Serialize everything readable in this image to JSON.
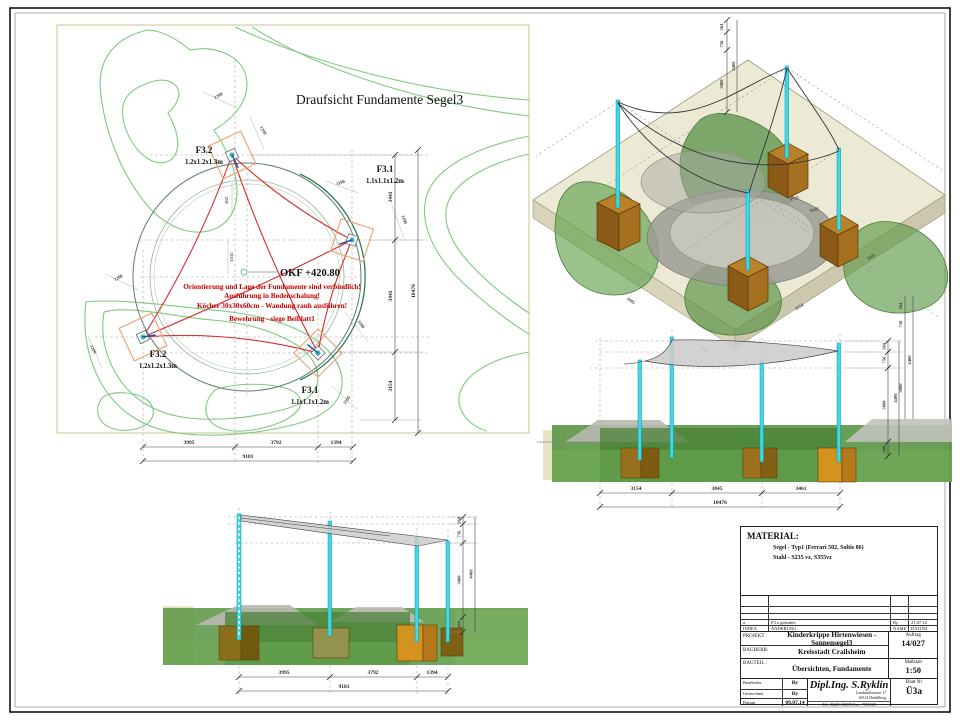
{
  "plan": {
    "title": "Draufsicht Fundamente Segel3",
    "okf": "OKF +420.80",
    "notes": [
      "Orientierung und Lage der Fundamente sind verbindlich!",
      "Ausführung in Bodenschalung!",
      "Köcher 30x30x60cm - Wandung rauh ausführen!",
      "Bewehrung - siege Beiblatt1"
    ],
    "foundations": [
      {
        "id": "F3.2",
        "size": "1.2x1.2x1.3m"
      },
      {
        "id": "F3.1",
        "size": "1.1x1.1x1.2m"
      },
      {
        "id": "F3.2",
        "size": "1.2x1.2x1.3m"
      },
      {
        "id": "F3.1",
        "size": "1.1x1.1x1.2m"
      }
    ],
    "dims": {
      "pocket_1200": "1200",
      "pocket_1100": "1100",
      "center_v": "1515",
      "center_s": "615",
      "right_chain": [
        "3441",
        "3441",
        "3154"
      ],
      "right_total": "10476",
      "bottom_chain": [
        "3995",
        "3792",
        "1394"
      ],
      "bottom_total": "9181"
    }
  },
  "iso": {
    "dims": {
      "v264": "264",
      "v756": "756",
      "v3000": "3000",
      "v400": "400",
      "v4400": "4400",
      "inner1": "3792",
      "inner2": "9181",
      "edge1": "3995",
      "edge2": "1394",
      "edge3": "3154",
      "edge4": "3441"
    }
  },
  "elev_right": {
    "bottom_chain": [
      "3154",
      "3845",
      "3461"
    ],
    "bottom_total": "10476",
    "side_chain": [
      "264",
      "756",
      "3000",
      "400"
    ],
    "side_total": "4400"
  },
  "elev_left": {
    "bottom_chain": [
      "3995",
      "3792",
      "1394"
    ],
    "bottom_total": "9181",
    "side_chain": [
      "264",
      "756",
      "3000",
      "400"
    ],
    "side_total": "4400"
  },
  "titleblock": {
    "material_title": "MATERIAL:",
    "material_lines": [
      "Segel   -   Typ1 (Ferrari  502, Soltis 86)",
      "Stahl   -   S235 vz, S355vz"
    ],
    "revision": {
      "index": "a",
      "change": "F3.x geändert",
      "name": "Ry",
      "date": "21.07.14",
      "h_index": "INDEX",
      "h_change": "ÄNDERUNG",
      "h_name": "NAME",
      "h_date": "DATUM"
    },
    "projekt_label": "PROJEKT :",
    "projekt": "Kinderkrippe Hirtenwiesen - Sonnensegel3",
    "auftrag_label": "Auftrag",
    "auftrag": "14/027",
    "bauherr_label": "BAUHERR:",
    "bauherr": "Kreisstadt Crailsheim",
    "bauteil_label": "BAUTEIL :",
    "bauteil": "Übersichten, Fundamente",
    "massstab_label": "Maßstab",
    "massstab": "1:50",
    "bearbeiter_label": "Bearbeiter",
    "bearbeiter": "Ry",
    "gezeichnet_label": "Gezeichnet",
    "gezeichnet": "Ry",
    "datum_label": "Datum",
    "datum": "09.07.14",
    "firma": "Dipl.Ing. S.Ryklin",
    "address1": "Landstuhlstrasse 17",
    "address2": "69123 Heidelberg",
    "tel": "Tel.: 06221-830673  Fax: -7965368",
    "blatt_label": "Blatt Nr",
    "blatt": "Ü3a"
  }
}
